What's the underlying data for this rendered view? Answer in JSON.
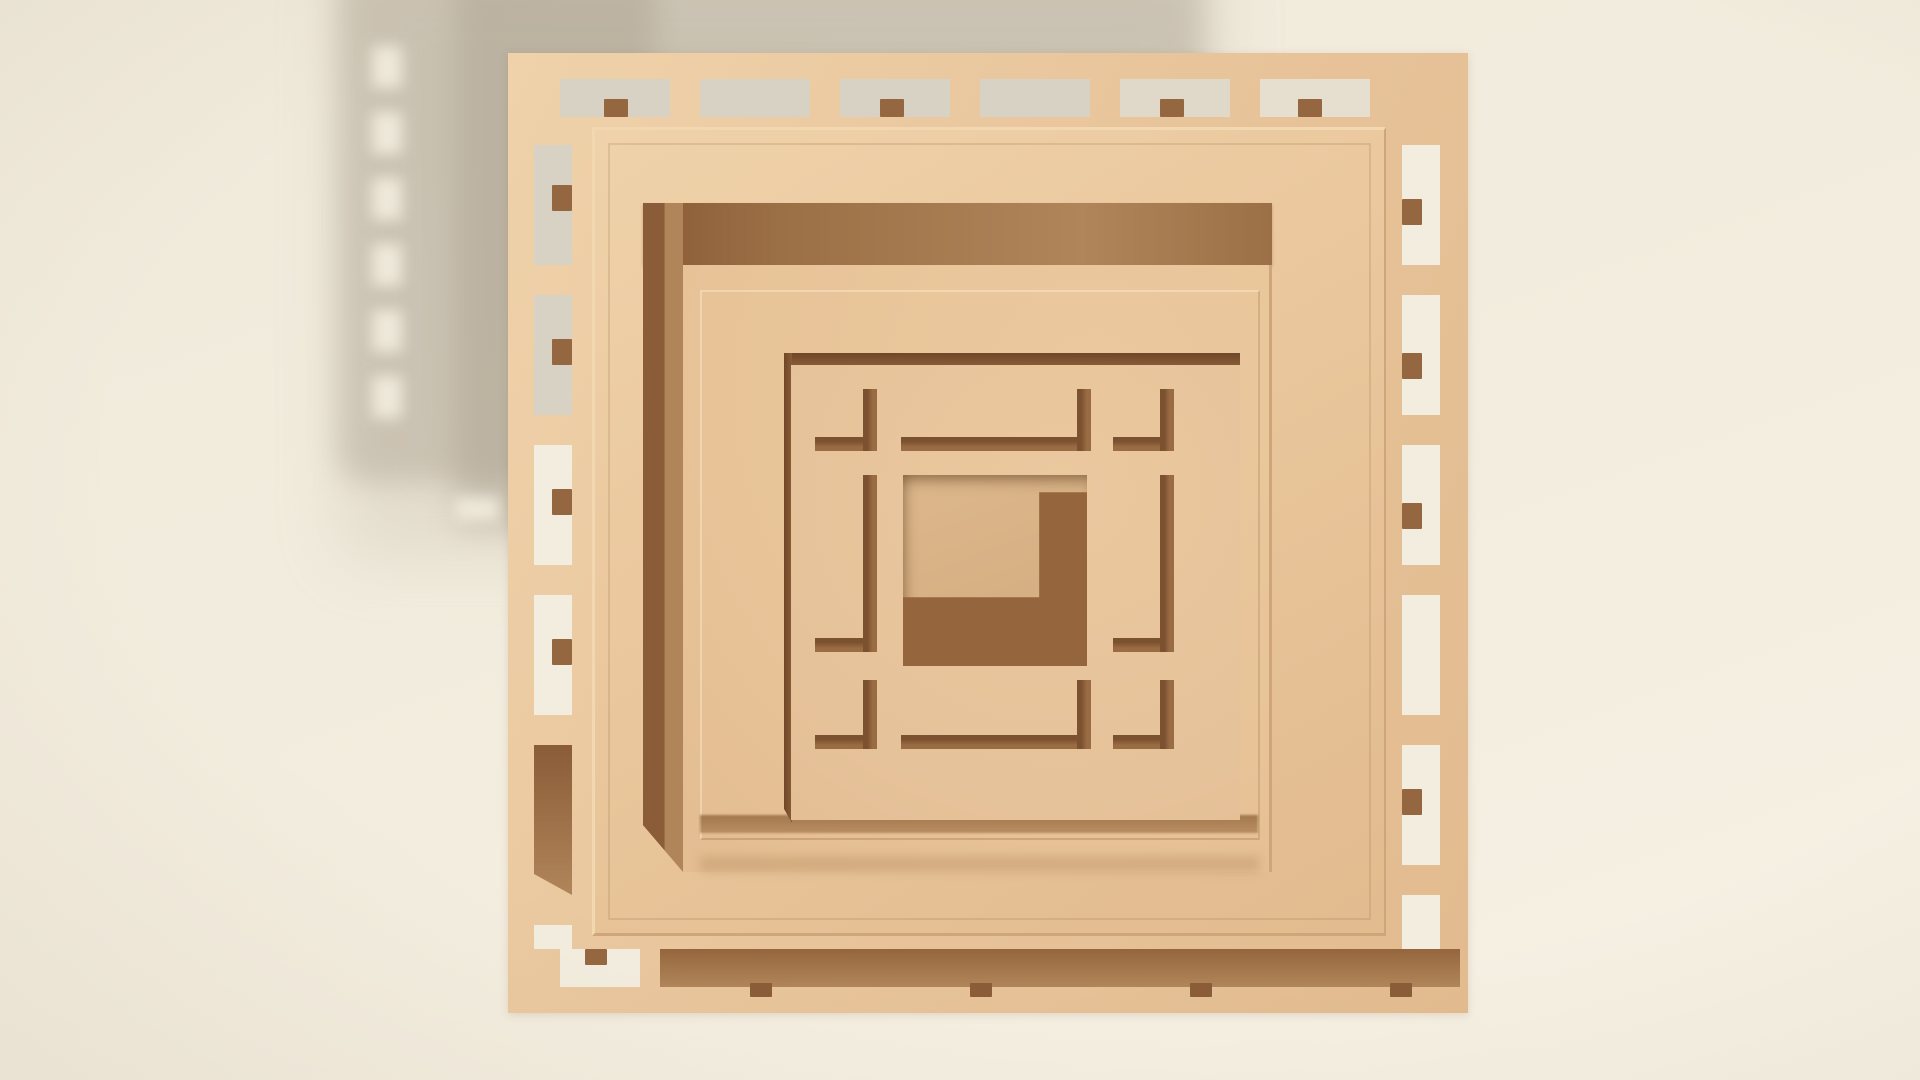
{
  "scene": {
    "type": "3d-render",
    "subject": "nested square wooden panels with lattice frame and window motif",
    "style": "soft studio lighting, tan monochrome, light from upper right",
    "parts": {
      "background": "cream backdrop",
      "cast_shadow": "soft gray shadow upper-left with slot-shaped light gaps",
      "lattice_frame": "outer square frame with slotted ladder border and small pegs",
      "large_plate": "big square plate stacked on frame",
      "middle_plate": "raised plate with dark left and top side faces in shadow",
      "window_panel": "square panel with L-shaped slots and square through-hole",
      "center_hole": "square opening, lit back wall upper-left, dark shadow lower-right"
    }
  },
  "colors": {
    "bg-top": "#f0eadb",
    "bg-mid": "#f3eddf",
    "bg-bottom": "#f6f1e4",
    "shadow-gray": "#a99f8d",
    "slot-gray": "#d8d2c4",
    "tan-frame": "#e9c59c",
    "tan-light": "#efd2aa",
    "tan-dark-face": "#e2bb8f",
    "plateA-face": "#ebc89e",
    "plateB-face": "#e8c398",
    "win-face": "#e6c29a",
    "bevel-light": "#f2d8b0",
    "bevel-dark": "#cfa679",
    "side-dark": "#8a5c38",
    "side-mid": "#b1855a",
    "side-shadow": "#9c7046",
    "edge-darkest": "#6f4728",
    "slot-brown": "#9a6c44",
    "slot-lip": "#7b5130",
    "tab-brown": "#956740",
    "hole-back": "#ddb88c",
    "hole-back2": "#d2ab7e",
    "hole-dark": "#95663d"
  }
}
